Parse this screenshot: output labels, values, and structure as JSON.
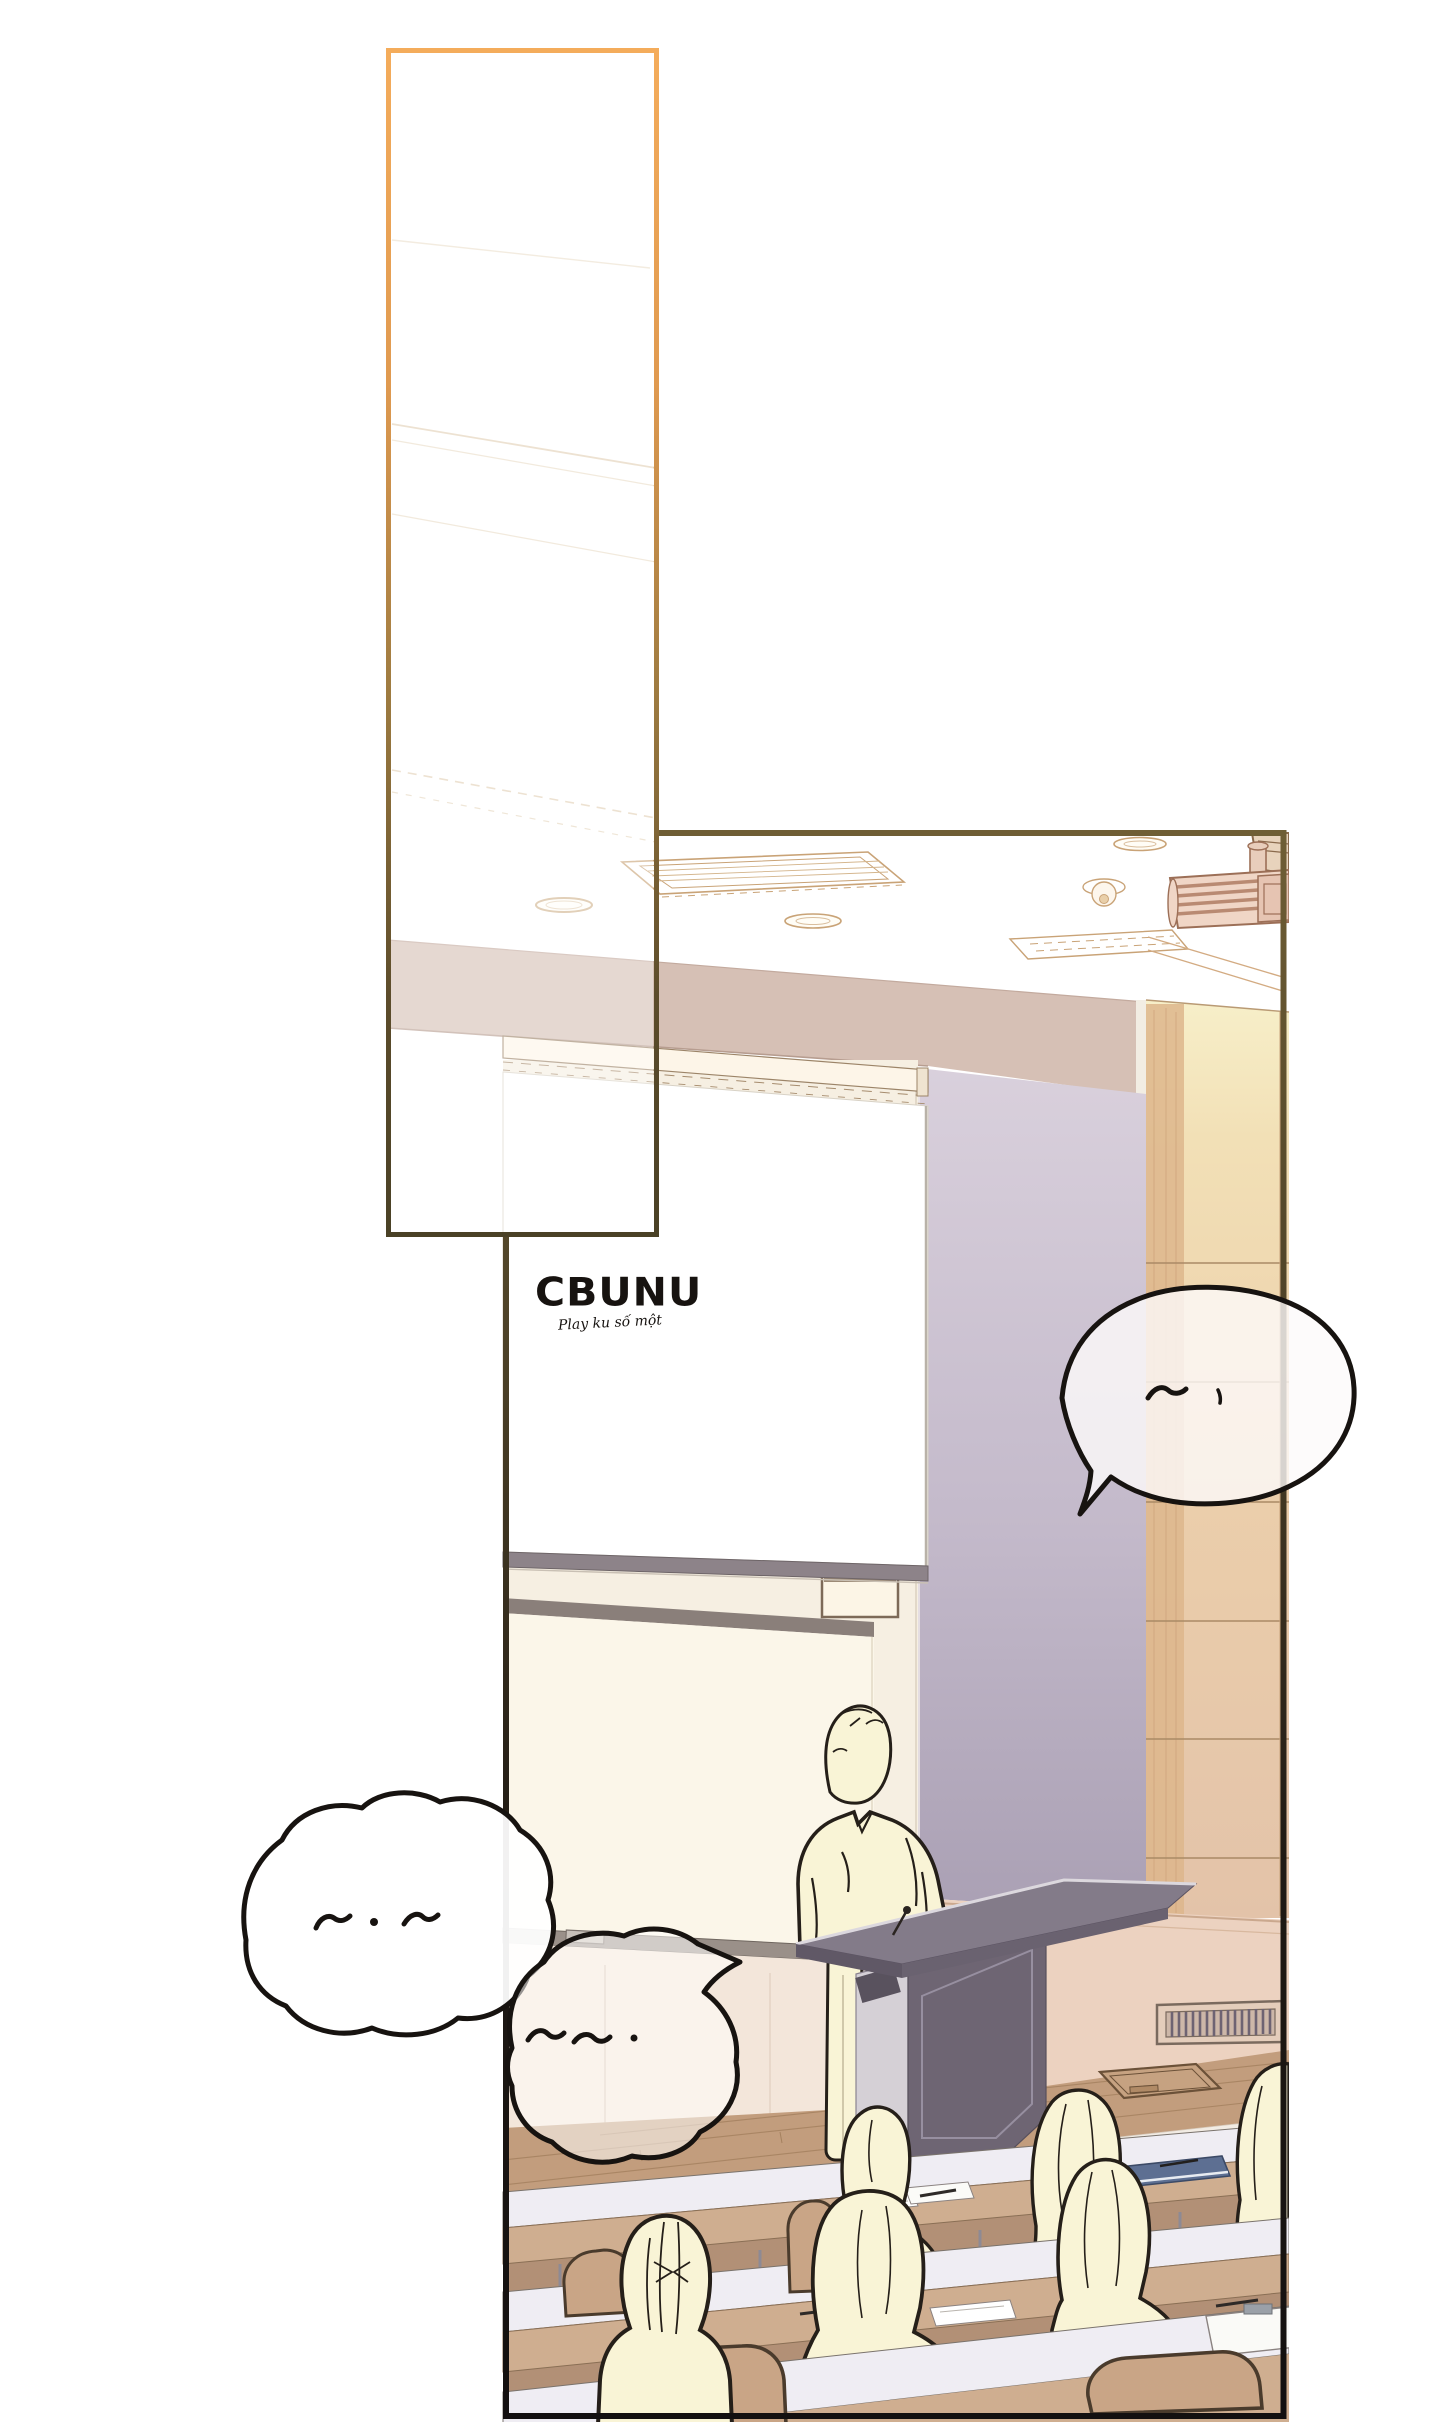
{
  "page": {
    "kind": "webtoon-comic-page",
    "background": "#ffffff",
    "scene_description": "Lecture hall seen from the audience: a faceless lecturer in a pale shirt stands at a purple podium in front of a large projection screen and whiteboard; wood panelled wall on the right, ceiling with vents, recessed lights, sprinkler and projector; rows of desks with cream audience silhouettes; one tall empty panel above-left."
  },
  "logo": {
    "title": "CBUNU",
    "subtitle": "Play ku số một"
  },
  "panels": [
    {
      "name": "tall-panel",
      "border": "orange-to-olive gradient",
      "x": 388,
      "y": 50,
      "w": 268,
      "h": 1185
    },
    {
      "name": "main-panel",
      "border": "olive-to-black gradient",
      "x": 503,
      "y": 831,
      "w": 783,
      "h": 1587
    }
  ],
  "bubbles": [
    {
      "name": "speech-bubble-right",
      "marks": "〜 ·",
      "tail": "bottom-left",
      "opacity": 0.8
    },
    {
      "name": "thought-bubble-upper-left",
      "marks": "〜 · 〜",
      "tail": "none",
      "opacity": 1.0
    },
    {
      "name": "thought-bubble-lower-left",
      "marks": "〜〜 ·",
      "tail": "upper-right",
      "opacity": 0.55
    }
  ],
  "scene_elements": [
    "ceiling-vent",
    "recessed-light",
    "sprinkler-head",
    "ceiling-projector",
    "speaker-box",
    "header-band",
    "wood-wall",
    "lavender-wall",
    "cream-wall",
    "projection-screen",
    "screen-housing",
    "whiteboard",
    "marker-tray",
    "display-niche",
    "wall-vent",
    "stage-floor",
    "floor-hatch",
    "stage-riser",
    "lecturer",
    "podium",
    "microphone",
    "desk-row",
    "audience-member",
    "chair",
    "paper-sheet",
    "blue-notebook",
    "clipboard",
    "pen"
  ],
  "colors": {
    "page-bg": "#ffffff",
    "ink": "#171310",
    "border-orange": "#f4ac5b",
    "border-olive": "#4a4126",
    "border-main-top": "#6f5e35",
    "border-main-bottom": "#131010",
    "outline-tan": "#c9a377",
    "band": "#d6c0b5",
    "wood-light": "#f7efc9",
    "wood-mid": "#eccfab",
    "wood-dark": "#ddb68c",
    "lavender-light": "#d9d0dc",
    "lavender-dark": "#aaa0b4",
    "cream-wall": "#f6efe2",
    "whiteboard": "#fbf6e9",
    "screen-bar": "#8d8389",
    "stage-floor": "#c29d7d",
    "riser-face": "#dcc3ae",
    "audience-floor": "#b29076",
    "desk-top": "#efedf3",
    "desk-front": "#cfae90",
    "chair": "#c9a586",
    "person-fill": "#f9f4d6",
    "person-outline": "#251f19",
    "podium-dark": "#6e6573",
    "podium-light": "#d5d0d6",
    "podium-top": "#837b89"
  }
}
